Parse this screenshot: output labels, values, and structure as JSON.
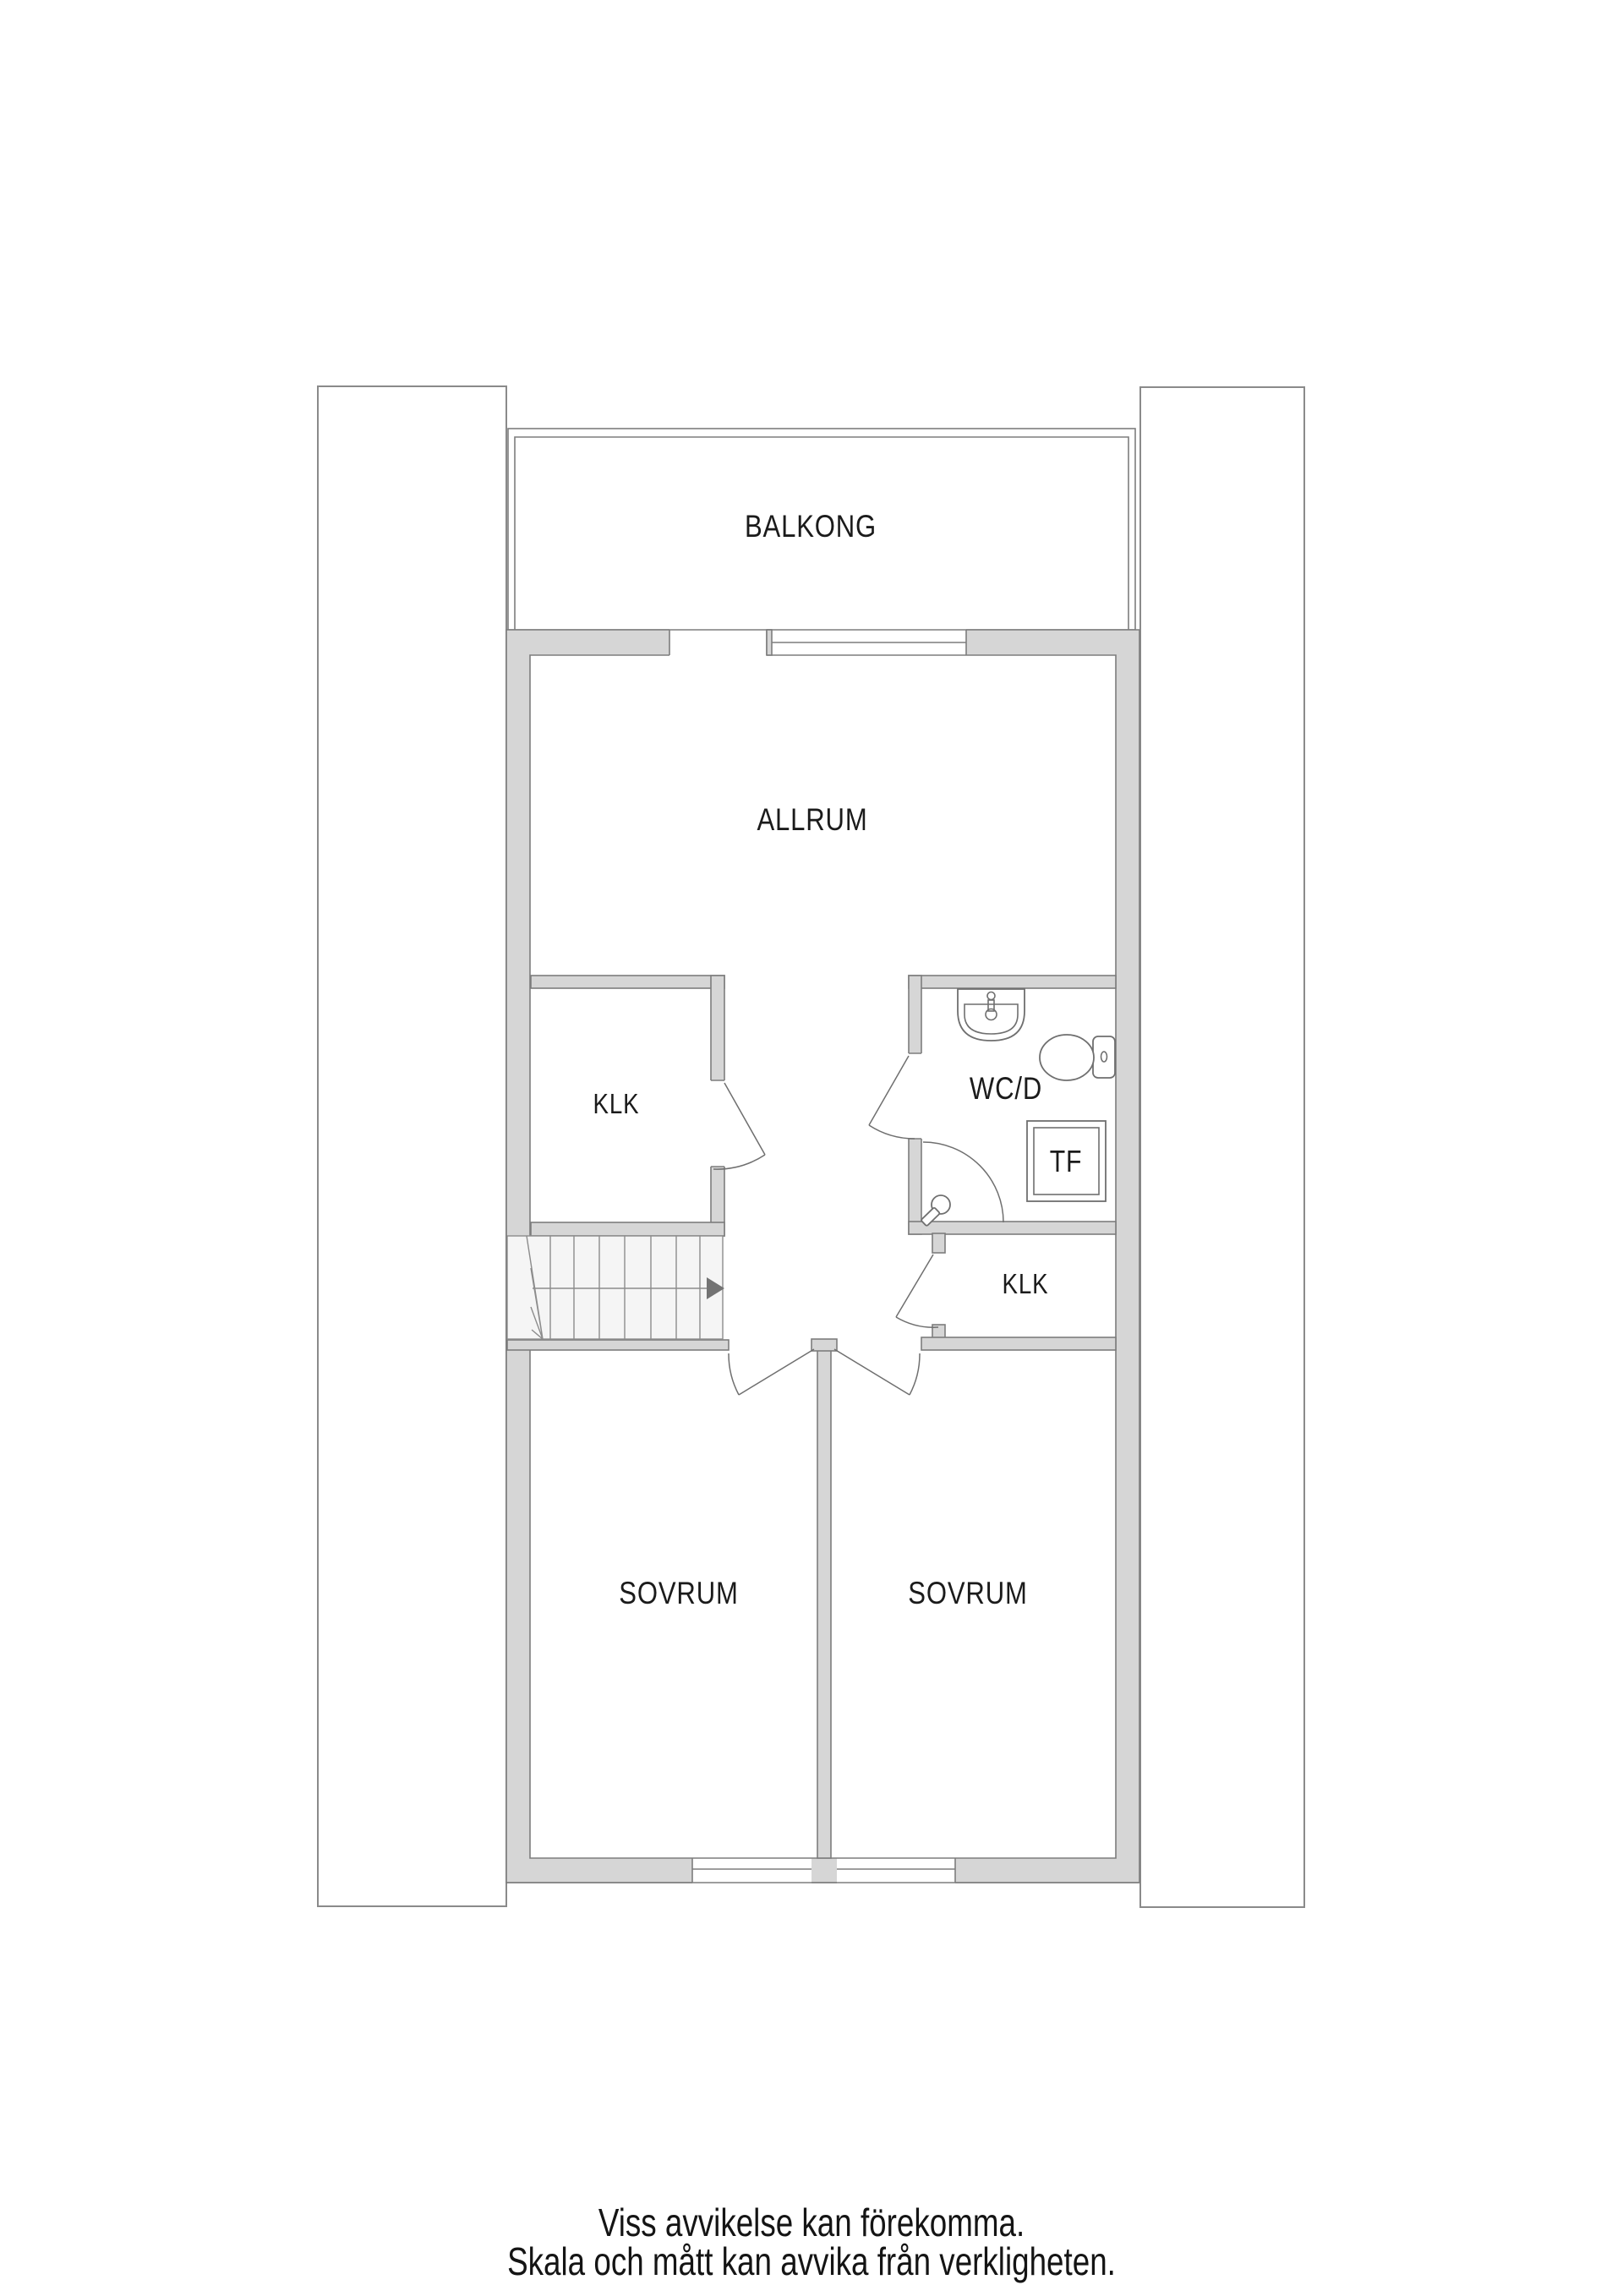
{
  "document": {
    "type": "floor-plan",
    "language": "sv"
  },
  "floor_plan": {
    "rooms": [
      {
        "id": "balkong",
        "label": "BALKONG"
      },
      {
        "id": "allrum",
        "label": "ALLRUM"
      },
      {
        "id": "klk-upper",
        "label": "KLK"
      },
      {
        "id": "wcd",
        "label": "WC/D"
      },
      {
        "id": "tf",
        "label": "TF"
      },
      {
        "id": "klk-lower",
        "label": "KLK"
      },
      {
        "id": "sovrum-left",
        "label": "SOVRUM"
      },
      {
        "id": "sovrum-right",
        "label": "SOVRUM"
      }
    ],
    "fixtures": [
      "sink-icon",
      "toilet-icon",
      "shower-head-icon",
      "drying-cabinet",
      "staircase",
      "stair-direction-arrow-icon"
    ],
    "colors": {
      "wall_fill": "#d6d6d6",
      "wall_outline": "#7d7d7d",
      "neighbor_unit_outline": "#8a8a8a",
      "stair_fill": "#f5f5f5",
      "arrow": "#737373",
      "label_text": "#1b1b1b"
    }
  },
  "footer": {
    "line1": "Viss avvikelse kan förekomma.",
    "line2": "Skala och mått kan avvika från verkligheten."
  }
}
